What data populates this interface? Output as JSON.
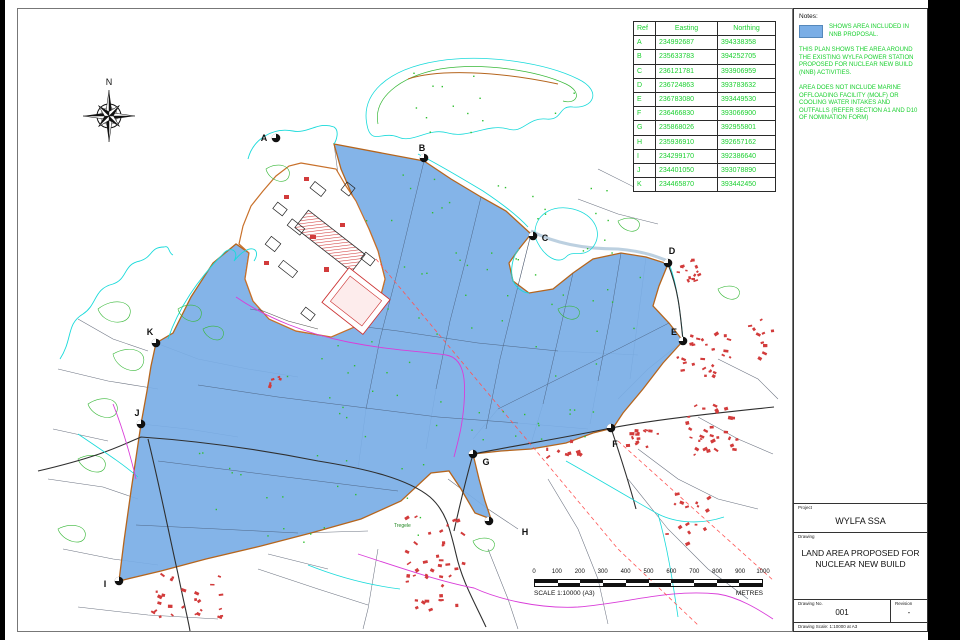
{
  "notes": {
    "title": "Notes:",
    "swatch_color": "#7AAEE6",
    "swatch_text": "SHOWS AREA INCLUDED IN NNB PROPOSAL.",
    "para1": "THIS PLAN SHOWS THE AREA AROUND THE EXISTING WYLFA POWER STATION PROPOSED FOR NUCLEAR NEW BUILD (NNB) ACTIVITIES.",
    "para2": "AREA DOES NOT INCLUDE MARINE OFFLOADING FACILITY (MOLF) OR COOLING WATER INTAKES AND OUTFALLS (REFER SECTION A1 AND D10 OF NOMINATION FORM)"
  },
  "coordinate_table": {
    "headers": [
      "Ref",
      "Easting",
      "Northing"
    ],
    "rows": [
      [
        "A",
        "234992687",
        "394338358"
      ],
      [
        "B",
        "235633783",
        "394252705"
      ],
      [
        "C",
        "236121781",
        "393906959"
      ],
      [
        "D",
        "236724863",
        "393783632"
      ],
      [
        "E",
        "236783080",
        "393449530"
      ],
      [
        "F",
        "236466830",
        "393066900"
      ],
      [
        "G",
        "235868026",
        "392955801"
      ],
      [
        "H",
        "235936910",
        "392657162"
      ],
      [
        "I",
        "234299170",
        "392386640"
      ],
      [
        "J",
        "234401050",
        "393078890"
      ],
      [
        "K",
        "234465870",
        "393442450"
      ]
    ]
  },
  "title_block": {
    "project_label": "Project",
    "project": "WYLFA SSA",
    "drawing_label": "Drawing",
    "drawing_title": "LAND AREA PROPOSED FOR NUCLEAR NEW BUILD",
    "drawing_no_label": "Drawing No.",
    "drawing_no": "001",
    "revision_label": "Revision",
    "revision": "-",
    "scale_note": "Drawing Scale: 1:10000 at A3"
  },
  "scale_bar": {
    "ticks": [
      "0",
      "100",
      "200",
      "300",
      "400",
      "500",
      "600",
      "700",
      "800",
      "900",
      "1000"
    ],
    "scale_text": "SCALE 1:10000 (A3)",
    "units": "METRES"
  },
  "compass": {
    "north_label": "N"
  },
  "map": {
    "area_fill": "#7AAEE6",
    "area_border": "#B5651D",
    "markers": [
      {
        "label": "A",
        "x": 258,
        "y": 129,
        "lx": -12,
        "ly": 0
      },
      {
        "label": "B",
        "x": 406,
        "y": 149,
        "lx": -2,
        "ly": -10
      },
      {
        "label": "C",
        "x": 515,
        "y": 227,
        "lx": 12,
        "ly": 2
      },
      {
        "label": "D",
        "x": 650,
        "y": 254,
        "lx": 4,
        "ly": -12
      },
      {
        "label": "E",
        "x": 665,
        "y": 332,
        "lx": -9,
        "ly": -9
      },
      {
        "label": "F",
        "x": 593,
        "y": 419,
        "lx": 4,
        "ly": 16
      },
      {
        "label": "G",
        "x": 455,
        "y": 445,
        "lx": 13,
        "ly": 8
      },
      {
        "label": "H",
        "x": 471,
        "y": 512,
        "lx": 36,
        "ly": 11
      },
      {
        "label": "I",
        "x": 101,
        "y": 572,
        "lx": -14,
        "ly": 3
      },
      {
        "label": "J",
        "x": 123,
        "y": 415,
        "lx": -4,
        "ly": -11
      },
      {
        "label": "K",
        "x": 138,
        "y": 334,
        "lx": -6,
        "ly": -11
      }
    ],
    "labels": [
      {
        "text": "Tregele",
        "x": 376,
        "y": 518
      }
    ]
  }
}
